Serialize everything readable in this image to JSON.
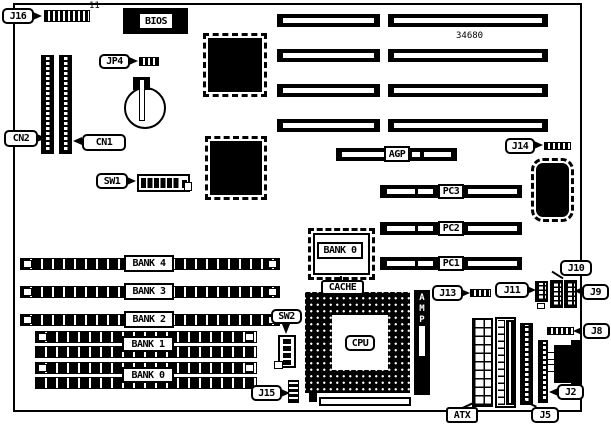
{
  "diagram": {
    "kind": "Motherboard layout diagram",
    "board_number": "34680",
    "j16_pin_count": "11"
  },
  "labels": {
    "j16": "J16",
    "bios": "BIOS",
    "jp4": "JP4",
    "cn2": "CN2",
    "cn1": "CN1",
    "sw1": "SW1",
    "sw2": "SW2",
    "j14": "J14",
    "j13": "J13",
    "j15": "J15",
    "j11": "J11",
    "j10": "J10",
    "j9": "J9",
    "j8": "J8",
    "j5": "J5",
    "j2": "J2",
    "atx": "ATX",
    "agp": "AGP",
    "pci3": "PC3",
    "pci2": "PC2",
    "pci1": "PC1",
    "bank4": "BANK 4",
    "bank3": "BANK 3",
    "bank2": "BANK 2",
    "bank1": "BANK 1",
    "bank0": "BANK 0",
    "cache_bank0": "BANK 0",
    "cache": "CACHE",
    "cpu": "CPU",
    "amp": "AMP"
  }
}
